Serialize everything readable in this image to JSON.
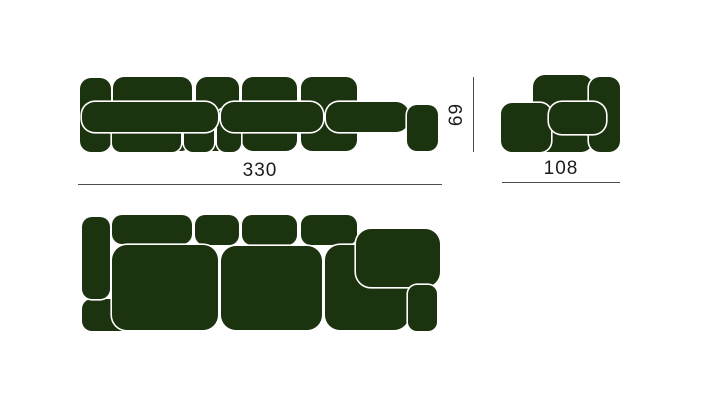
{
  "diagram": {
    "type": "modular-sofa-dimension-diagram",
    "dimensions": {
      "width": "330",
      "depth": "108",
      "height": "69"
    },
    "colors": {
      "sofa_fill": "#1c330f",
      "sofa_outline": "#ffffff",
      "dimension_line": "#4d4d4d",
      "dimension_text": "#1c1c1c",
      "background": "#ffffff"
    }
  }
}
